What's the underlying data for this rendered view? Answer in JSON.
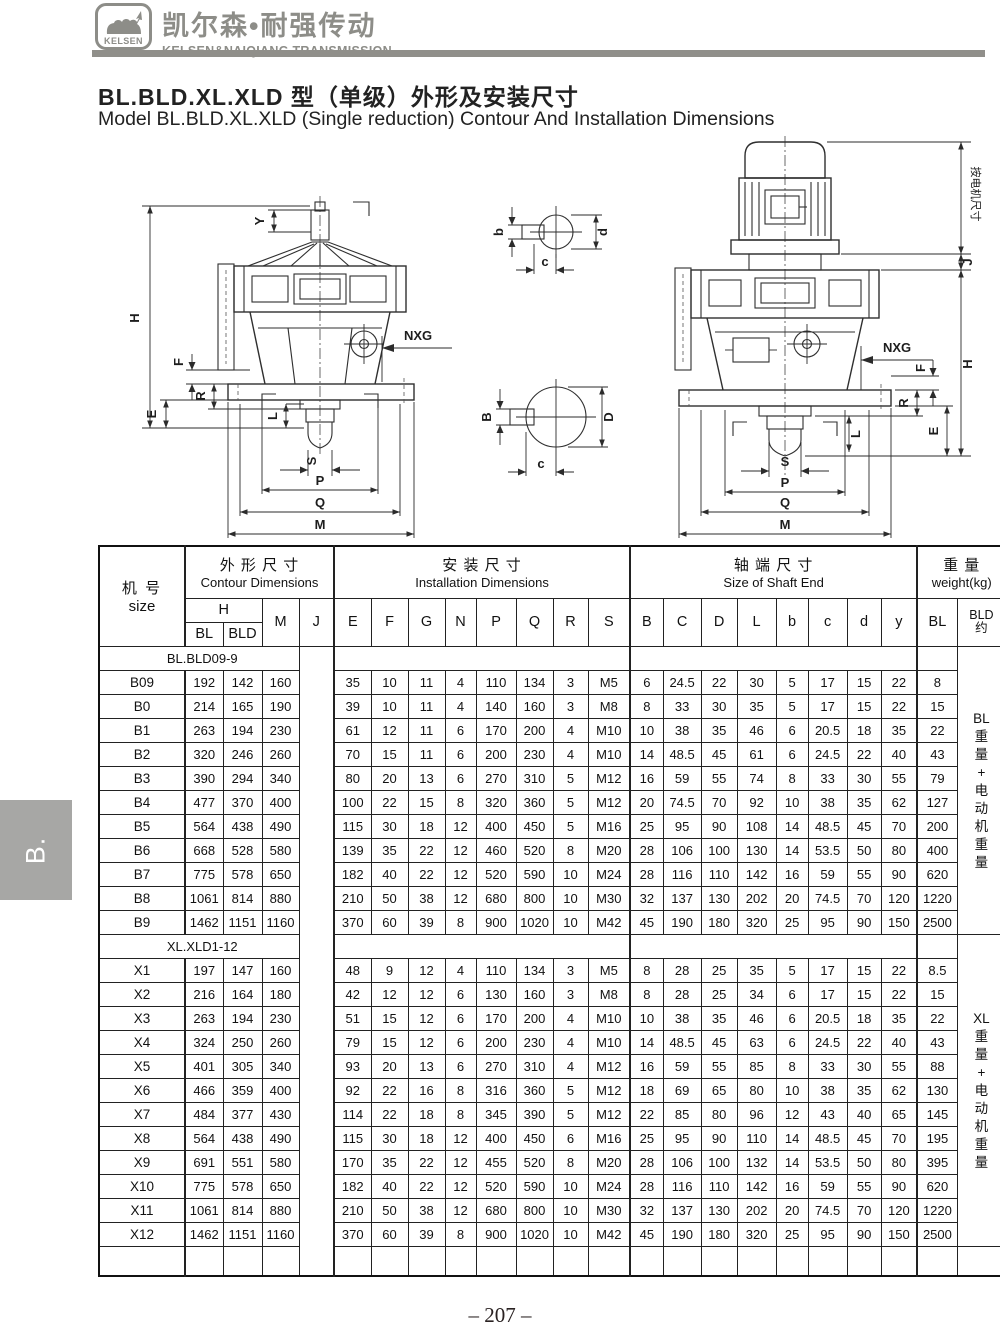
{
  "brand": {
    "logo_text": "KELSEN",
    "name_cn": "凯尔森•耐强传动",
    "name_en": "KELSEN&NAIQIANG TRANSMISSION"
  },
  "title": {
    "cn": "BL.BLD.XL.XLD 型（单级）外形及安装尺寸",
    "en": "Model BL.BLD.XL.XLD (Single reduction) Contour And Installation Dimensions"
  },
  "side_tab": "B.",
  "page_number": "– 207 –",
  "drawings": {
    "left": {
      "y": "Y",
      "h": "H",
      "f": "F",
      "e": "E",
      "r": "R",
      "l": "L",
      "s": "S",
      "p": "P",
      "q": "Q",
      "m": "M",
      "nxg": "NXG"
    },
    "right": {
      "motor": "按电机尺寸",
      "j": "J",
      "h": "H",
      "f": "F",
      "e": "E",
      "r": "R",
      "l": "L",
      "s": "S",
      "p": "P",
      "q": "Q",
      "m": "M",
      "nxg": "NXG"
    },
    "sections": {
      "small_b": "b",
      "small_d": "d",
      "small_c": "c",
      "large_b": "B",
      "large_d": "D",
      "large_c": "c"
    }
  },
  "table": {
    "size_header": {
      "cn": "机 号",
      "en": "size"
    },
    "group_headers": {
      "contour": {
        "cn": "外 形 尺 寸",
        "en": "Contour Dimensions"
      },
      "install": {
        "cn": "安 装 尺 寸",
        "en": "Installation Dimensions"
      },
      "shaft": {
        "cn": "轴 端 尺 寸",
        "en": "Size of Shaft End"
      },
      "weight": {
        "cn": "重 量",
        "en": "weight(kg)"
      }
    },
    "sub_headers": {
      "h": "H",
      "bl": "BL",
      "bld": "BLD",
      "m": "M",
      "j": "J",
      "e": "E",
      "f": "F",
      "g": "G",
      "n": "N",
      "p": "P",
      "q": "Q",
      "r": "R",
      "s": "S",
      "B": "B",
      "C": "C",
      "D": "D",
      "L": "L",
      "b": "b",
      "c": "c",
      "d": "d",
      "y": "y",
      "w_bl": "BL",
      "w_bld": "BLD",
      "w_approx": "约"
    },
    "groups": [
      {
        "label": "BL.BLD09-9",
        "weight_note": "BL重量+电动机重量",
        "rows": [
          [
            "B09",
            "192",
            "142",
            "160",
            "35",
            "10",
            "11",
            "4",
            "110",
            "134",
            "3",
            "M5",
            "6",
            "24.5",
            "22",
            "30",
            "5",
            "17",
            "15",
            "22",
            "8"
          ],
          [
            "B0",
            "214",
            "165",
            "190",
            "39",
            "10",
            "11",
            "4",
            "140",
            "160",
            "3",
            "M8",
            "8",
            "33",
            "30",
            "35",
            "5",
            "17",
            "15",
            "22",
            "15"
          ],
          [
            "B1",
            "263",
            "194",
            "230",
            "61",
            "12",
            "11",
            "6",
            "170",
            "200",
            "4",
            "M10",
            "10",
            "38",
            "35",
            "46",
            "6",
            "20.5",
            "18",
            "35",
            "22"
          ],
          [
            "B2",
            "320",
            "246",
            "260",
            "70",
            "15",
            "11",
            "6",
            "200",
            "230",
            "4",
            "M10",
            "14",
            "48.5",
            "45",
            "61",
            "6",
            "24.5",
            "22",
            "40",
            "43"
          ],
          [
            "B3",
            "390",
            "294",
            "340",
            "80",
            "20",
            "13",
            "6",
            "270",
            "310",
            "5",
            "M12",
            "16",
            "59",
            "55",
            "74",
            "8",
            "33",
            "30",
            "55",
            "79"
          ],
          [
            "B4",
            "477",
            "370",
            "400",
            "100",
            "22",
            "15",
            "8",
            "320",
            "360",
            "5",
            "M12",
            "20",
            "74.5",
            "70",
            "92",
            "10",
            "38",
            "35",
            "62",
            "127"
          ],
          [
            "B5",
            "564",
            "438",
            "490",
            "115",
            "30",
            "18",
            "12",
            "400",
            "450",
            "5",
            "M16",
            "25",
            "95",
            "90",
            "108",
            "14",
            "48.5",
            "45",
            "70",
            "200"
          ],
          [
            "B6",
            "668",
            "528",
            "580",
            "139",
            "35",
            "22",
            "12",
            "460",
            "520",
            "8",
            "M20",
            "28",
            "106",
            "100",
            "130",
            "14",
            "53.5",
            "50",
            "80",
            "400"
          ],
          [
            "B7",
            "775",
            "578",
            "650",
            "182",
            "40",
            "22",
            "12",
            "520",
            "590",
            "10",
            "M24",
            "28",
            "116",
            "110",
            "142",
            "16",
            "59",
            "55",
            "90",
            "620"
          ],
          [
            "B8",
            "1061",
            "814",
            "880",
            "210",
            "50",
            "38",
            "12",
            "680",
            "800",
            "10",
            "M30",
            "32",
            "137",
            "130",
            "202",
            "20",
            "74.5",
            "70",
            "120",
            "1220"
          ],
          [
            "B9",
            "1462",
            "1151",
            "1160",
            "370",
            "60",
            "39",
            "8",
            "900",
            "1020",
            "10",
            "M42",
            "45",
            "190",
            "180",
            "320",
            "25",
            "95",
            "90",
            "150",
            "2500"
          ]
        ]
      },
      {
        "label": "XL.XLD1-12",
        "weight_note": "XL重量+电动机重量",
        "rows": [
          [
            "X1",
            "197",
            "147",
            "160",
            "48",
            "9",
            "12",
            "4",
            "110",
            "134",
            "3",
            "M5",
            "8",
            "28",
            "25",
            "35",
            "5",
            "17",
            "15",
            "22",
            "8.5"
          ],
          [
            "X2",
            "216",
            "164",
            "180",
            "42",
            "12",
            "12",
            "6",
            "130",
            "160",
            "3",
            "M8",
            "8",
            "28",
            "25",
            "34",
            "6",
            "17",
            "15",
            "22",
            "15"
          ],
          [
            "X3",
            "263",
            "194",
            "230",
            "51",
            "15",
            "12",
            "6",
            "170",
            "200",
            "4",
            "M10",
            "10",
            "38",
            "35",
            "46",
            "6",
            "20.5",
            "18",
            "35",
            "22"
          ],
          [
            "X4",
            "324",
            "250",
            "260",
            "79",
            "15",
            "12",
            "6",
            "200",
            "230",
            "4",
            "M10",
            "14",
            "48.5",
            "45",
            "63",
            "6",
            "24.5",
            "22",
            "40",
            "43"
          ],
          [
            "X5",
            "401",
            "305",
            "340",
            "93",
            "20",
            "13",
            "6",
            "270",
            "310",
            "4",
            "M12",
            "16",
            "59",
            "55",
            "85",
            "8",
            "33",
            "30",
            "55",
            "88"
          ],
          [
            "X6",
            "466",
            "359",
            "400",
            "92",
            "22",
            "16",
            "8",
            "316",
            "360",
            "5",
            "M12",
            "18",
            "69",
            "65",
            "80",
            "10",
            "38",
            "35",
            "62",
            "130"
          ],
          [
            "X7",
            "484",
            "377",
            "430",
            "114",
            "22",
            "18",
            "8",
            "345",
            "390",
            "5",
            "M12",
            "22",
            "85",
            "80",
            "96",
            "12",
            "43",
            "40",
            "65",
            "145"
          ],
          [
            "X8",
            "564",
            "438",
            "490",
            "115",
            "30",
            "18",
            "12",
            "400",
            "450",
            "6",
            "M16",
            "25",
            "95",
            "90",
            "110",
            "14",
            "48.5",
            "45",
            "70",
            "195"
          ],
          [
            "X9",
            "691",
            "551",
            "580",
            "170",
            "35",
            "22",
            "12",
            "455",
            "520",
            "8",
            "M20",
            "28",
            "106",
            "100",
            "132",
            "14",
            "53.5",
            "50",
            "80",
            "395"
          ],
          [
            "X10",
            "775",
            "578",
            "650",
            "182",
            "40",
            "22",
            "12",
            "520",
            "590",
            "10",
            "M24",
            "28",
            "116",
            "110",
            "142",
            "16",
            "59",
            "55",
            "90",
            "620"
          ],
          [
            "X11",
            "1061",
            "814",
            "880",
            "210",
            "50",
            "38",
            "12",
            "680",
            "800",
            "10",
            "M30",
            "32",
            "137",
            "130",
            "202",
            "20",
            "74.5",
            "70",
            "120",
            "1220"
          ],
          [
            "X12",
            "1462",
            "1151",
            "1160",
            "370",
            "60",
            "39",
            "8",
            "900",
            "1020",
            "10",
            "M42",
            "45",
            "190",
            "180",
            "320",
            "25",
            "95",
            "90",
            "150",
            "2500"
          ]
        ]
      }
    ]
  }
}
